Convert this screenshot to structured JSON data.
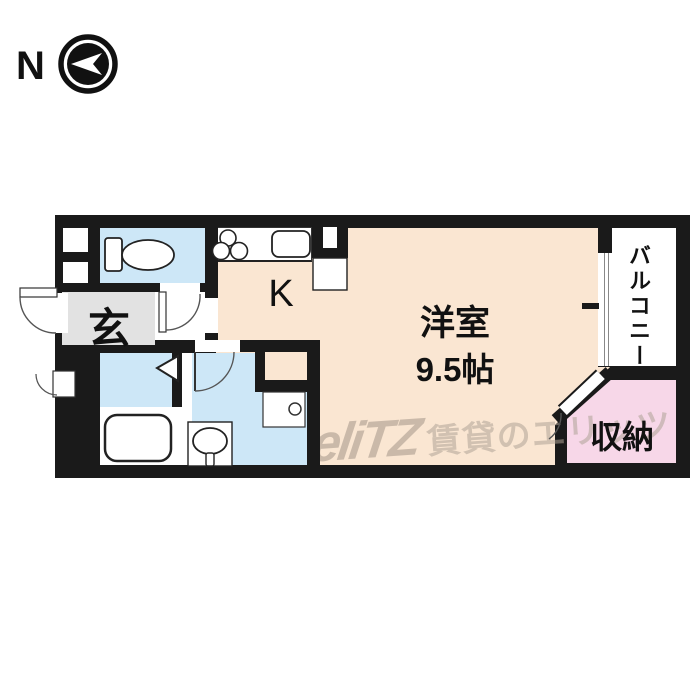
{
  "compass": {
    "label": "N",
    "icon": "compass-north-arrow-icon"
  },
  "watermark": {
    "logo": "eliTZ",
    "text": "賃貸のエリッツ"
  },
  "rooms": {
    "entrance": {
      "label": "玄"
    },
    "kitchen": {
      "label": "K"
    },
    "main_room": {
      "label": "洋室",
      "size": "9.5帖"
    },
    "balcony": {
      "label": "バルコニー"
    },
    "storage": {
      "label": "収納"
    }
  },
  "fixtures": {
    "toilet": "toilet-icon",
    "stove": "stove-burners-icon",
    "sink": "kitchen-sink-icon",
    "refrigerator_space": "refrigerator-space",
    "bathtub": "bathtub-icon",
    "washbasin": "washbasin-icon",
    "washing_machine_pan": "washing-machine-pan-icon",
    "entrance_door": "swing-door-icon",
    "toilet_door": "swing-door-icon",
    "washroom_door": "swing-door-icon",
    "bathroom_door": "folding-door-icon",
    "storage_door": "swing-door-icon",
    "balcony_window": "sliding-window-icon"
  },
  "colors": {
    "wall": "#1a1a1a",
    "floor_main": "#fae6d2",
    "floor_wet": "#cde7f7",
    "floor_entrance": "#e2e2e2",
    "floor_storage": "#f7d7e8",
    "floor_balcony": "#ffffff",
    "watermark": "#b9a99e"
  }
}
